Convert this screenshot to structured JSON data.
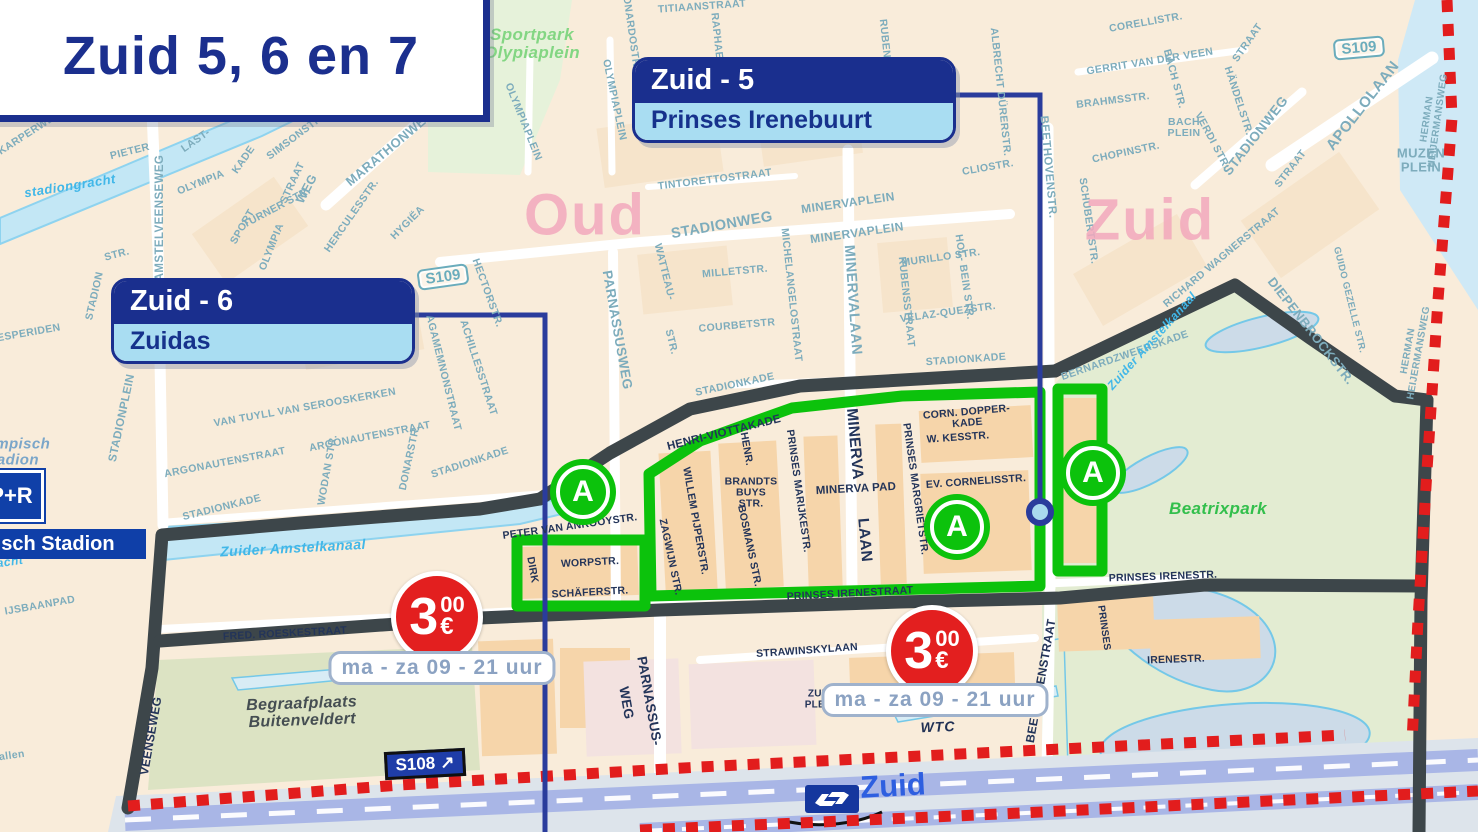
{
  "title": {
    "text": "Zuid 5, 6 en 7"
  },
  "callouts": {
    "zuid5": {
      "zone": "Zuid - 5",
      "area": "Prinses Irenebuurt"
    },
    "zuid6": {
      "zone": "Zuid - 6",
      "area": "Zuidas"
    }
  },
  "parking": {
    "euros": "3",
    "cents": "00",
    "currency": "€",
    "hours": "ma - za 09 - 21 uur"
  },
  "road_badges": {
    "s109_top": "S109",
    "s109_mid": "S109",
    "s108": "S108",
    "s108_arrow": "↗"
  },
  "station": {
    "name": "Zuid",
    "operator_icon": "ns-logo"
  },
  "stadium": {
    "pr": "P+R",
    "name": "Olympisch Stadion"
  },
  "zone_markers": [
    {
      "letter": "A",
      "x": 583,
      "y": 492
    },
    {
      "letter": "A",
      "x": 957,
      "y": 527
    },
    {
      "letter": "A",
      "x": 1093,
      "y": 473
    }
  ],
  "colors": {
    "navy": "#1a2f8e",
    "callout_light": "#a9ddf2",
    "zone_green": "#0cc20c",
    "boundary_dark": "#3d464a",
    "boundary_red": "#e21d1d",
    "price_red": "#e31f1f",
    "street_teal": "#7dacbc",
    "street_dark": "#233459",
    "water": "#c3e7f5",
    "district_pink": "#f2a9bd",
    "park_green": "#e3ecd2"
  },
  "street_labels": [
    {
      "t": "KARPERWEG",
      "x": 30,
      "y": 133,
      "r": -33
    },
    {
      "t": "PIETER",
      "x": 130,
      "y": 152,
      "r": -14
    },
    {
      "t": "AMSTELVEENSEWEG",
      "x": 160,
      "y": 218,
      "r": -90,
      "s": 11.5
    },
    {
      "t": "LAST-",
      "x": 196,
      "y": 141,
      "r": -35
    },
    {
      "t": "KADE",
      "x": 244,
      "y": 160,
      "r": -55
    },
    {
      "t": "OLYMPIA",
      "x": 201,
      "y": 183,
      "r": -22
    },
    {
      "t": "SIMSONSTR.",
      "x": 296,
      "y": 137,
      "r": -37
    },
    {
      "t": "STRAAT",
      "x": 293,
      "y": 183,
      "r": -65
    },
    {
      "t": "TURNER STR.",
      "x": 277,
      "y": 208,
      "r": -28
    },
    {
      "t": "SPORT",
      "x": 243,
      "y": 227,
      "r": -60
    },
    {
      "t": "OLYMPIA",
      "x": 272,
      "y": 247,
      "r": -68
    },
    {
      "t": "WEG",
      "x": 307,
      "y": 189,
      "r": -62,
      "s": 12.5
    },
    {
      "t": "MARATHONWEG",
      "x": 390,
      "y": 148,
      "r": -40,
      "s": 13
    },
    {
      "t": "HERCULESSTR.",
      "x": 352,
      "y": 216,
      "r": -55
    },
    {
      "t": "HYGIËA",
      "x": 408,
      "y": 223,
      "r": -45
    },
    {
      "t": "STR.",
      "x": 117,
      "y": 255,
      "r": -15
    },
    {
      "t": "STADION",
      "x": 95,
      "y": 296,
      "r": -77
    },
    {
      "t": "STADIONPLEIN",
      "x": 122,
      "y": 418,
      "r": -78,
      "s": 11.5
    },
    {
      "t": "HESPERIDEN",
      "x": 25,
      "y": 334,
      "r": -10
    },
    {
      "t": "STADIONKADE",
      "x": 222,
      "y": 508,
      "r": -14
    },
    {
      "t": "ARGONAUTENSTRAAT",
      "x": 225,
      "y": 463,
      "r": -11
    },
    {
      "t": "ARGONAUTENSTRAAT",
      "x": 370,
      "y": 437,
      "r": -11
    },
    {
      "t": "VAN TUYLL VAN SEROOSKERKEN",
      "x": 305,
      "y": 408,
      "r": -10
    },
    {
      "t": "WODAN STR.",
      "x": 328,
      "y": 470,
      "r": -80
    },
    {
      "t": "DONARSTR.",
      "x": 410,
      "y": 458,
      "r": -78
    },
    {
      "t": "AGAMEMNONSTRAAT",
      "x": 443,
      "y": 373,
      "r": 76
    },
    {
      "t": "ACHILLESSTRAAT",
      "x": 478,
      "y": 368,
      "r": 72
    },
    {
      "t": "HECTORSTR.",
      "x": 487,
      "y": 293,
      "r": 70
    },
    {
      "t": "STADIONKADE",
      "x": 470,
      "y": 463,
      "r": -18
    },
    {
      "t": "OLYMPIAPLEIN",
      "x": 614,
      "y": 100,
      "r": 78
    },
    {
      "t": "OLYMPIAPLEIN",
      "x": 523,
      "y": 122,
      "r": 68
    },
    {
      "t": "LEONARDOSTR.",
      "x": 630,
      "y": 26,
      "r": 82
    },
    {
      "t": "TITIAANSTRAAT",
      "x": 702,
      "y": 7,
      "r": -4
    },
    {
      "t": "RAPHAELSTR.",
      "x": 718,
      "y": 52,
      "r": 84
    },
    {
      "t": "MICHELANGELOSTRAAT",
      "x": 791,
      "y": 295,
      "r": 84
    },
    {
      "t": "RUBENSSTR.",
      "x": 886,
      "y": 55,
      "r": 84
    },
    {
      "t": "TINTORETTOSTRAAT",
      "x": 715,
      "y": 180,
      "r": -7
    },
    {
      "t": "STADIONWEG",
      "x": 722,
      "y": 226,
      "r": -10,
      "s": 14.5
    },
    {
      "t": "MINERVAPLEIN",
      "x": 848,
      "y": 203,
      "r": -8,
      "s": 12
    },
    {
      "t": "MINERVAPLEIN",
      "x": 857,
      "y": 233,
      "r": -8,
      "s": 12
    },
    {
      "t": "MILLETSTR.",
      "x": 735,
      "y": 272,
      "r": -5
    },
    {
      "t": "COURBETSTR",
      "x": 737,
      "y": 326,
      "r": -5
    },
    {
      "t": "PARNASSUSWEG",
      "x": 617,
      "y": 330,
      "r": 80,
      "s": 13.5
    },
    {
      "t": "WATTEAU-",
      "x": 664,
      "y": 272,
      "r": 76
    },
    {
      "t": "STR.",
      "x": 671,
      "y": 342,
      "r": 76
    },
    {
      "t": "MINERVALAAN",
      "x": 852,
      "y": 300,
      "r": 86,
      "s": 14.5
    },
    {
      "t": "RUBENSSTRAAT",
      "x": 906,
      "y": 302,
      "r": 84
    },
    {
      "t": "MURILLO STR.",
      "x": 941,
      "y": 258,
      "r": -8
    },
    {
      "t": "HOL- BEIN STR.",
      "x": 964,
      "y": 277,
      "r": 82
    },
    {
      "t": "VELAZ-QUEZSTR.",
      "x": 948,
      "y": 313,
      "r": -8
    },
    {
      "t": "CLIOSTR.",
      "x": 988,
      "y": 168,
      "r": -10
    },
    {
      "t": "STADIONKADE",
      "x": 966,
      "y": 360,
      "r": -4
    },
    {
      "t": "STADIONKADE",
      "x": 735,
      "y": 385,
      "r": -12
    },
    {
      "t": "BEETHOVENSTR.",
      "x": 1048,
      "y": 167,
      "r": 85,
      "s": 11.5
    },
    {
      "t": "SCHUBERTSTR.",
      "x": 1088,
      "y": 221,
      "r": 82
    },
    {
      "t": "ALBRECHT DÜRERSTR.",
      "x": 1000,
      "y": 92,
      "r": 84
    },
    {
      "t": "CORELLISTR.",
      "x": 1146,
      "y": 23,
      "r": -10
    },
    {
      "t": "GERRIT VAN DER VEEN",
      "x": 1150,
      "y": 62,
      "r": -9
    },
    {
      "t": "STRAAT",
      "x": 1248,
      "y": 43,
      "r": -55
    },
    {
      "t": "BRAHMSSTR.",
      "x": 1113,
      "y": 101,
      "r": -7
    },
    {
      "t": "BACH STR.",
      "x": 1174,
      "y": 79,
      "r": 75
    },
    {
      "t": "BACH\nPLEIN",
      "x": 1184,
      "y": 128,
      "r": 0
    },
    {
      "t": "CHOPINSTR.",
      "x": 1126,
      "y": 153,
      "r": -12
    },
    {
      "t": "HÄNDELSTR.",
      "x": 1238,
      "y": 101,
      "r": 72
    },
    {
      "t": "VERDI STR.",
      "x": 1212,
      "y": 141,
      "r": 62
    },
    {
      "t": "STADIONWEG",
      "x": 1256,
      "y": 136,
      "r": -52,
      "s": 13.5
    },
    {
      "t": "STRAAT",
      "x": 1291,
      "y": 169,
      "r": -52
    },
    {
      "t": "APOLLOLAAN",
      "x": 1363,
      "y": 106,
      "r": -52,
      "s": 15
    },
    {
      "t": "MUZEN\nPLEIN",
      "x": 1421,
      "y": 160,
      "r": 0,
      "s": 13
    },
    {
      "t": "HERMAN HEIJERMANSWEG",
      "x": 1433,
      "y": 120,
      "r": -82,
      "s": 10
    },
    {
      "t": "HERMAN HEIJERMANSWEG",
      "x": 1414,
      "y": 352,
      "r": -80,
      "s": 10
    },
    {
      "t": "GUIDO GEZELLE STR.",
      "x": 1349,
      "y": 300,
      "r": 76,
      "s": 9.5
    },
    {
      "t": "RICHARD WAGNERSTRAAT",
      "x": 1222,
      "y": 258,
      "r": -40
    },
    {
      "t": "BERNARDZWEERSKADE",
      "x": 1125,
      "y": 356,
      "r": -19
    },
    {
      "t": "DIEPENBROCKSTR.",
      "x": 1311,
      "y": 331,
      "r": 52,
      "s": 13
    },
    {
      "t": "allen",
      "x": 12,
      "y": 756,
      "r": -8
    },
    {
      "t": "IJSBAANPAD",
      "x": 40,
      "y": 606,
      "r": -10
    },
    {
      "t": "PETER VAN ANROOYSTR.",
      "x": 570,
      "y": 527,
      "r": -8,
      "c": "dz"
    },
    {
      "t": "DIRK",
      "x": 532,
      "y": 570,
      "r": 80,
      "c": "dz"
    },
    {
      "t": "WORPSTR.",
      "x": 590,
      "y": 563,
      "r": -3,
      "c": "dz"
    },
    {
      "t": "SCHÄFERSTR.",
      "x": 590,
      "y": 593,
      "r": -3,
      "c": "dz"
    },
    {
      "t": "HENRI-VIOTTAKADE",
      "x": 724,
      "y": 433,
      "r": -14,
      "s": 11.5,
      "c": "dz"
    },
    {
      "t": "HENR.",
      "x": 746,
      "y": 449,
      "r": 80,
      "c": "dz"
    },
    {
      "t": "WILLEM PIJPERSTR.",
      "x": 695,
      "y": 521,
      "r": 80,
      "c": "dz"
    },
    {
      "t": "BRANDTS\nBUYS\nSTR.",
      "x": 751,
      "y": 493,
      "r": 0,
      "c": "dz"
    },
    {
      "t": "BOSMANS STR.",
      "x": 749,
      "y": 546,
      "r": 78,
      "c": "dz"
    },
    {
      "t": "ZAGWIJN STR.",
      "x": 670,
      "y": 557,
      "r": 78,
      "c": "dz"
    },
    {
      "t": "PRINSES MARIJKESTR.",
      "x": 798,
      "y": 491,
      "r": 82,
      "c": "dz"
    },
    {
      "t": "MINERVA PAD",
      "x": 856,
      "y": 489,
      "r": -3,
      "s": 11.5,
      "c": "dz"
    },
    {
      "t": "MINERVA",
      "x": 854,
      "y": 444,
      "r": 85,
      "s": 15.5,
      "c": "dz"
    },
    {
      "t": "LAAN",
      "x": 864,
      "y": 540,
      "r": 85,
      "s": 15.5,
      "c": "dz"
    },
    {
      "t": "PRINSES MARGRIETSTR.",
      "x": 915,
      "y": 489,
      "r": 82,
      "c": "dz"
    },
    {
      "t": "CORN. DOPPER-\nKADE",
      "x": 967,
      "y": 418,
      "r": -5,
      "c": "dz"
    },
    {
      "t": "W. KESSTR.",
      "x": 958,
      "y": 438,
      "r": -4,
      "c": "dz"
    },
    {
      "t": "EV. CORNELISSTR.",
      "x": 976,
      "y": 482,
      "r": -4,
      "c": "dz"
    },
    {
      "t": "PRINSES IRENESTRAAT",
      "x": 850,
      "y": 594,
      "r": -3,
      "c": "dz"
    },
    {
      "t": "PRINSES IRENESTR.",
      "x": 1163,
      "y": 577,
      "r": -2,
      "c": "dz"
    },
    {
      "t": "FRED. ROESKESTRAAT",
      "x": 285,
      "y": 634,
      "r": -3,
      "c": "dz"
    },
    {
      "t": "STRAWINSKYLAAN",
      "x": 807,
      "y": 651,
      "r": -4,
      "c": "dz"
    },
    {
      "t": "ZUID\nPLEIN",
      "x": 820,
      "y": 700,
      "r": 0,
      "s": 10,
      "c": "dz"
    },
    {
      "t": "BEETHOVENSTRAAT",
      "x": 1041,
      "y": 681,
      "r": -80,
      "s": 12,
      "c": "dz"
    },
    {
      "t": "PRINSES",
      "x": 1103,
      "y": 628,
      "r": 82,
      "s": 10,
      "c": "dz"
    },
    {
      "t": "IRENESTR.",
      "x": 1176,
      "y": 660,
      "r": -2,
      "c": "dz"
    },
    {
      "t": "PARNASSUS-",
      "x": 649,
      "y": 701,
      "r": 80,
      "s": 13.5,
      "c": "dz"
    },
    {
      "t": "WEG",
      "x": 626,
      "y": 703,
      "r": 80,
      "s": 13.5,
      "c": "dz"
    },
    {
      "t": "VEENSEWEG",
      "x": 151,
      "y": 736,
      "r": -80,
      "s": 12,
      "c": "dz"
    },
    {
      "t": "Zuider Amstelkanaal",
      "x": 293,
      "y": 548,
      "r": -3,
      "s": 14,
      "c": "wl"
    },
    {
      "t": "Zuider Amstelkanaal",
      "x": 1152,
      "y": 341,
      "r": -48,
      "s": 12,
      "c": "wl"
    },
    {
      "t": "stadiongracht",
      "x": 70,
      "y": 186,
      "r": -9,
      "s": 13,
      "c": "wl"
    },
    {
      "t": "Stadiongracht",
      "x": -20,
      "y": 566,
      "r": -8,
      "s": 12,
      "c": "wl"
    },
    {
      "t": "Sportpark\nOlypiaplein",
      "x": 532,
      "y": 44,
      "r": 0,
      "s": 17,
      "c": "pk"
    },
    {
      "t": "Beatrixpark",
      "x": 1218,
      "y": 509,
      "r": 0,
      "s": 17,
      "c": "bx"
    },
    {
      "t": "Begraafplaats\nBuitenveldert",
      "x": 302,
      "y": 713,
      "r": -2,
      "s": 16,
      "c": "cem"
    },
    {
      "t": "Olympisch\nStadion",
      "x": 10,
      "y": 452,
      "r": 0,
      "s": 15,
      "c": "os"
    },
    {
      "t": "Oud",
      "x": 585,
      "y": 216,
      "r": 0,
      "s": 58,
      "c": "dist"
    },
    {
      "t": "Zuid",
      "x": 1150,
      "y": 221,
      "r": 0,
      "s": 58,
      "c": "dist"
    },
    {
      "t": "WTC",
      "x": 938,
      "y": 727,
      "r": -2,
      "s": 14,
      "c": "wtc"
    }
  ]
}
